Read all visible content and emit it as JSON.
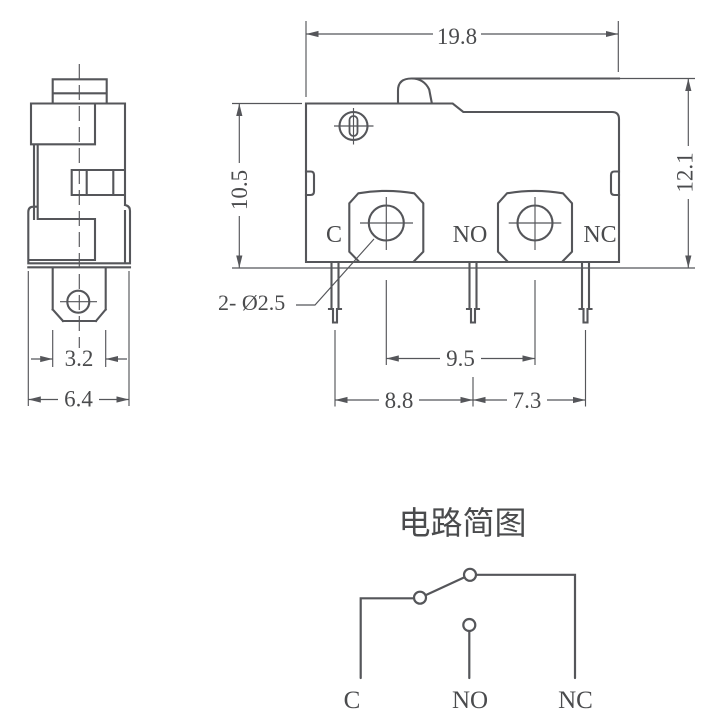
{
  "colors": {
    "line": "#55565a",
    "text": "#4a4b4d",
    "background": "#ffffff"
  },
  "front_view": {
    "dim_width": "19.8",
    "dim_height_total": "12.1",
    "dim_height_body": "10.5",
    "dim_hole_spacing": "9.5",
    "dim_pin_spacing_left": "8.8",
    "dim_pin_spacing_right": "7.3",
    "hole_note": "2- Ø2.5",
    "labels": {
      "common": "C",
      "normally_open": "NO",
      "normally_closed": "NC"
    }
  },
  "side_view": {
    "dim_terminal_width": "3.2",
    "dim_body_width": "6.4"
  },
  "circuit": {
    "title": "电路简图",
    "labels": {
      "common": "C",
      "normally_open": "NO",
      "normally_closed": "NC"
    }
  }
}
